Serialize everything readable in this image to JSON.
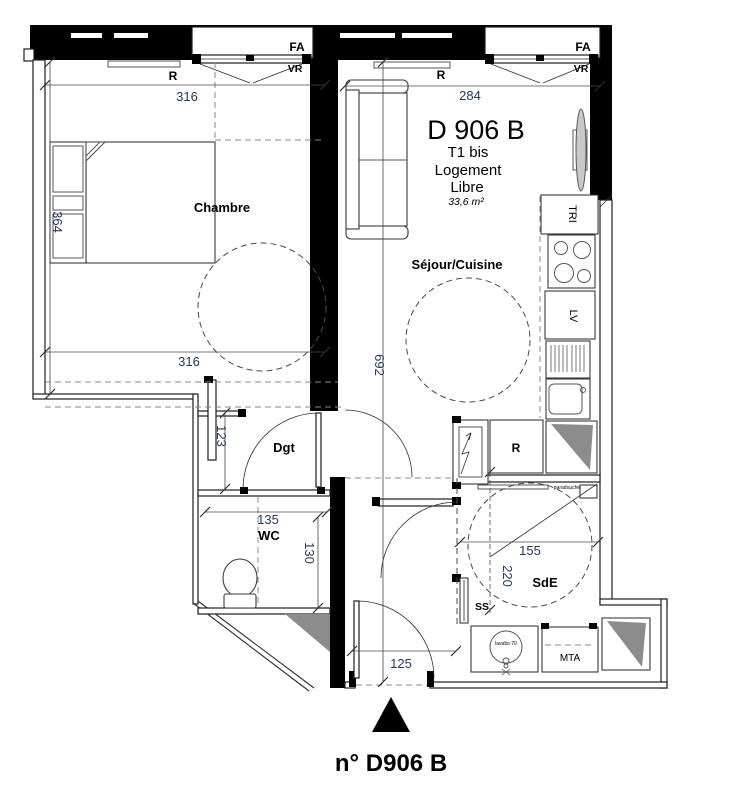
{
  "plan": {
    "title": {
      "unit": "D 906 B",
      "type": "T1 bis",
      "tenure_line1": "Logement",
      "tenure_line2": "Libre",
      "area": "33,6 m²"
    },
    "footer": {
      "unit_number": "n° D906 B"
    },
    "rooms": {
      "chambre": "Chambre",
      "sejour_cuisine": "Séjour/Cuisine",
      "dgt": "Dgt",
      "wc": "WC",
      "sde": "SdE"
    },
    "labels": {
      "fa": "FA",
      "vr": "VR",
      "radiator": "R",
      "fridge": "R",
      "tri": "TRI",
      "lv": "LV",
      "mta": "MTA",
      "ss": "SS",
      "shower_screen": "paradouche",
      "washbasin": "lavabo 70"
    },
    "dimensions": {
      "bedroom_top": "316",
      "living_top": "284",
      "bedroom_left": "364",
      "bedroom_bottom": "316",
      "living_height": "692",
      "hall": "123",
      "wc_width": "135",
      "wc_depth": "130",
      "bathroom_width": "155",
      "bathroom_depth": "220",
      "entry_width": "125"
    },
    "colors": {
      "dimension_text": "#1F3864",
      "wall": "#000000",
      "shading": "#8C8C8C",
      "background": "#FFFFFF"
    }
  }
}
